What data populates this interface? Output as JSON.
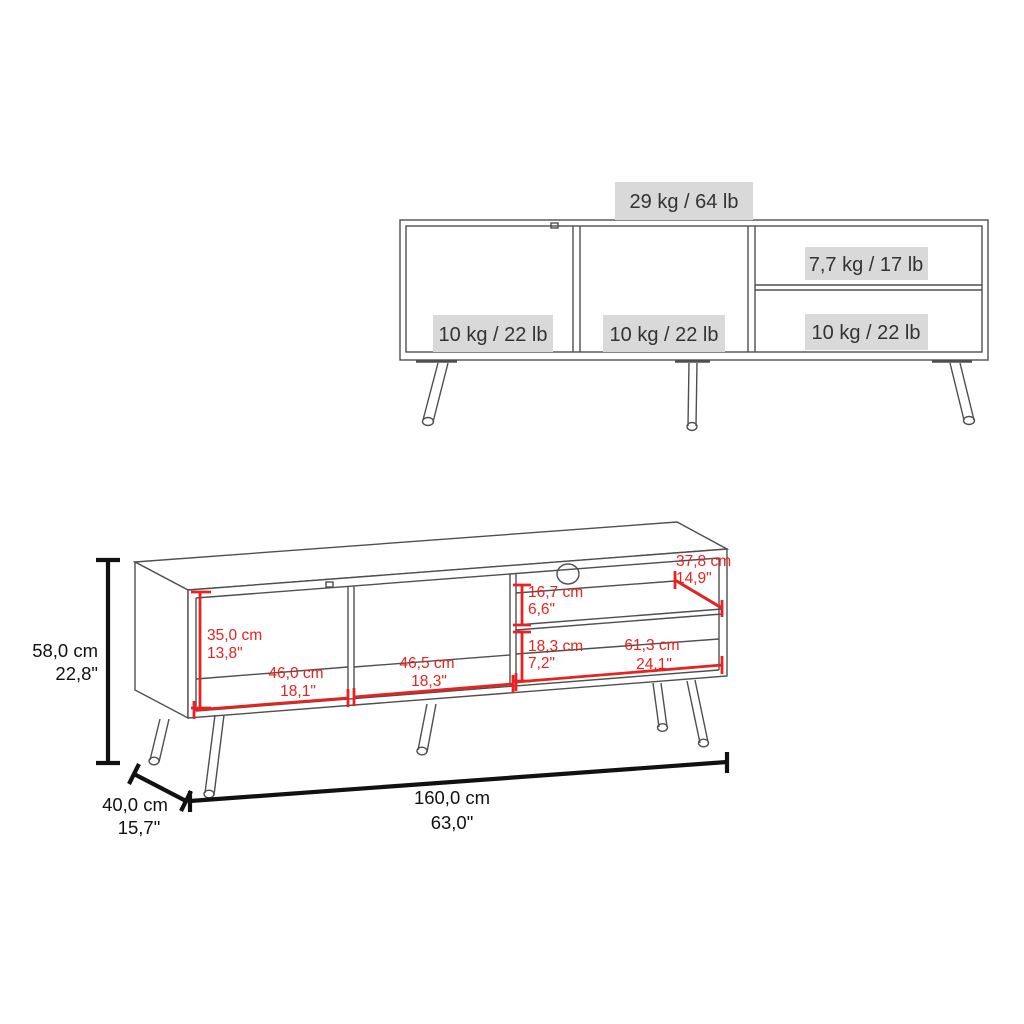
{
  "front_view": {
    "max_load_top": "29 kg / 64 lb",
    "max_load_left_compartment": "10 kg / 22 lb",
    "max_load_middle_compartment": "10 kg / 22 lb",
    "max_load_right_shelf": "7,7 kg / 17 lb",
    "max_load_right_bottom_compartment": "10 kg / 22 lb"
  },
  "dimension_view": {
    "overall_height_cm": "58,0 cm",
    "overall_height_in": "22,8\"",
    "overall_depth_cm": "40,0 cm",
    "overall_depth_in": "15,7\"",
    "overall_width_cm": "160,0 cm",
    "overall_width_in": "63,0\"",
    "left_opening_height_cm": "35,0 cm",
    "left_opening_height_in": "13,8\"",
    "left_opening_width_cm": "46,0 cm",
    "left_opening_width_in": "18,1\"",
    "middle_opening_width_cm": "46,5 cm",
    "middle_opening_width_in": "18,3\"",
    "right_top_opening_height_cm": "16,7 cm",
    "right_top_opening_height_in": "6,6\"",
    "shelf_depth_cm": "37,8 cm",
    "shelf_depth_in": "14,9\"",
    "right_bottom_opening_height_cm": "18,3 cm",
    "right_bottom_opening_height_in": "7,2\"",
    "right_bottom_opening_width_cm": "61,3 cm",
    "right_bottom_opening_width_in": "24,1\""
  },
  "colors": {
    "dimension_highlight": "#e62320",
    "dimension_black": "#111111",
    "drawing_line": "#4f4f4f",
    "label_background": "#d9d9d9"
  }
}
